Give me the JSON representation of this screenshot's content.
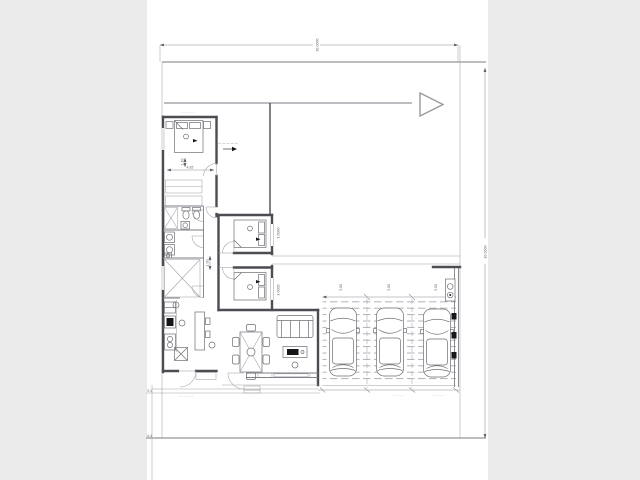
{
  "colors": {
    "background": "#ebebec",
    "page": "#ffffff",
    "wall": "#4c4c52",
    "thin_line": "#a2a2a8",
    "dimension_line": "#8d8d94",
    "accent_black": "#17171a"
  },
  "texts": {
    "dim_top": "30.0000",
    "dim_right": "30.0000",
    "dim_bed1_width": "4.85",
    "dim_bed1_depth": "1.50",
    "dim_hall": "1.00",
    "dim_bed2": "3.0000",
    "dim_bed3": "3.0000",
    "dim_bay1": "3.00",
    "dim_bay2": "3.00",
    "dim_bay3": "3.00",
    "bedroom1_label": "· · · · · · ·",
    "leader_note": "— — — — —",
    "porch_note": "· · · · · · ·",
    "garage_note_left": "· · · · ·",
    "garage_note_right": "· · · · · ·",
    "edge_label_top": "3.1",
    "edge_label_bottom": "4.4",
    "tv_label": "· · ·"
  }
}
